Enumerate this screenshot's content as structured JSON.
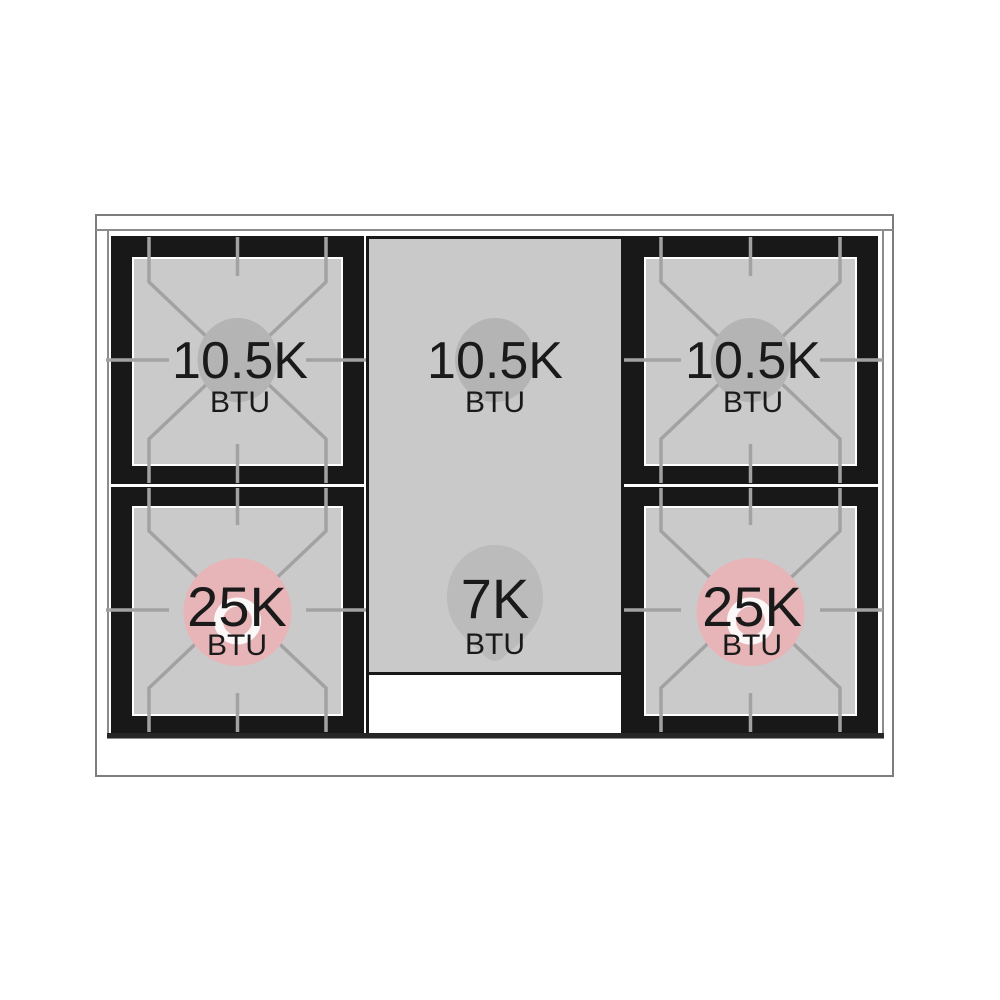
{
  "diagram": {
    "subject": "gas range cooktop burner layout (top view)",
    "burners": [
      {
        "position": "top-left",
        "value": "10.5K",
        "unit": "BTU"
      },
      {
        "position": "top-center",
        "value": "10.5K",
        "unit": "BTU"
      },
      {
        "position": "top-right",
        "value": "10.5K",
        "unit": "BTU"
      },
      {
        "position": "bottom-left",
        "value": "25K",
        "unit": "BTU"
      },
      {
        "position": "bottom-center",
        "value": "7K",
        "unit": "BTU"
      },
      {
        "position": "bottom-right",
        "value": "25K",
        "unit": "BTU"
      }
    ],
    "colors": {
      "burner_frame_black": "#181818",
      "surface_gray": "#cacaca",
      "grate_line_gray": "#a2a2a2",
      "standard_burner_highlight": "#b4b4b4",
      "high_output_burner_highlight": "#e7b5b8",
      "outline_gray": "#7d7d7d",
      "text_color": "#1a1a1a"
    }
  }
}
